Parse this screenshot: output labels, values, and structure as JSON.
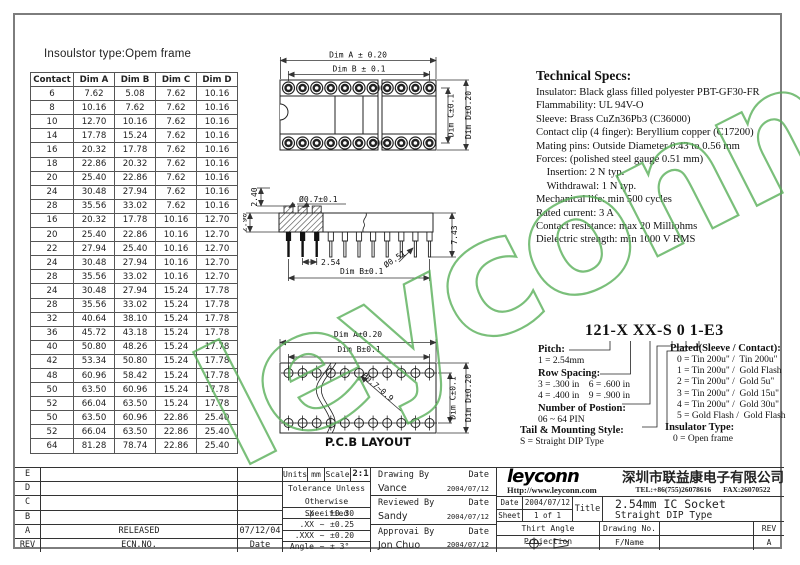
{
  "watermark": "leyconn",
  "insulator_note": "Insoulstor type:Opem frame",
  "dim_table": {
    "headers": [
      "Contact",
      "Dim A",
      "Dim B",
      "Dim C",
      "Dim D"
    ],
    "rows": [
      [
        "6",
        "7.62",
        "5.08",
        "7.62",
        "10.16"
      ],
      [
        "8",
        "10.16",
        "7.62",
        "7.62",
        "10.16"
      ],
      [
        "10",
        "12.70",
        "10.16",
        "7.62",
        "10.16"
      ],
      [
        "14",
        "17.78",
        "15.24",
        "7.62",
        "10.16"
      ],
      [
        "16",
        "20.32",
        "17.78",
        "7.62",
        "10.16"
      ],
      [
        "18",
        "22.86",
        "20.32",
        "7.62",
        "10.16"
      ],
      [
        "20",
        "25.40",
        "22.86",
        "7.62",
        "10.16"
      ],
      [
        "24",
        "30.48",
        "27.94",
        "7.62",
        "10.16"
      ],
      [
        "28",
        "35.56",
        "33.02",
        "7.62",
        "10.16"
      ],
      [
        "16",
        "20.32",
        "17.78",
        "10.16",
        "12.70"
      ],
      [
        "20",
        "25.40",
        "22.86",
        "10.16",
        "12.70"
      ],
      [
        "22",
        "27.94",
        "25.40",
        "10.16",
        "12.70"
      ],
      [
        "24",
        "30.48",
        "27.94",
        "10.16",
        "12.70"
      ],
      [
        "28",
        "35.56",
        "33.02",
        "10.16",
        "12.70"
      ],
      [
        "24",
        "30.48",
        "27.94",
        "15.24",
        "17.78"
      ],
      [
        "28",
        "35.56",
        "33.02",
        "15.24",
        "17.78"
      ],
      [
        "32",
        "40.64",
        "38.10",
        "15.24",
        "17.78"
      ],
      [
        "36",
        "45.72",
        "43.18",
        "15.24",
        "17.78"
      ],
      [
        "40",
        "50.80",
        "48.26",
        "15.24",
        "17.78"
      ],
      [
        "42",
        "53.34",
        "50.80",
        "15.24",
        "17.78"
      ],
      [
        "48",
        "60.96",
        "58.42",
        "15.24",
        "17.78"
      ],
      [
        "50",
        "63.50",
        "60.96",
        "15.24",
        "17.78"
      ],
      [
        "52",
        "66.04",
        "63.50",
        "15.24",
        "17.78"
      ],
      [
        "50",
        "63.50",
        "60.96",
        "22.86",
        "25.40"
      ],
      [
        "52",
        "66.04",
        "63.50",
        "22.86",
        "25.40"
      ],
      [
        "64",
        "81.28",
        "78.74",
        "22.86",
        "25.40"
      ]
    ]
  },
  "tech_specs": {
    "title": "Technical Specs:",
    "lines": [
      "Insulator: Black glass filled polyester PBT-GF30-FR",
      "Flammability: UL 94V-O",
      "Sleeve: Brass CuZn36Pb3 (C36000)",
      "Contact clip (4 finger): Beryllium copper (C17200)",
      "Mating pins: Outside Diameter 0.43 to 0.56 mm",
      "Forces: (polished steel gauge 0.51 mm)",
      "    Insertion: 2 N typ.",
      "    Withdrawal: 1 N typ.",
      "Mechanical life: min 500 cycles",
      "Rated current: 3 A",
      "Contact resistance: max 20 Milliohms",
      "Dielectric strength: min 1000 V RMS"
    ]
  },
  "drawings": {
    "top_view": {
      "dim_a": "Dim A ± 0.20",
      "dim_b": "Dim B ± 0.1",
      "dim_c": "Dim C±0.1",
      "dim_d": "Dim D±0.20"
    },
    "side_view": {
      "upper": "2.40",
      "standoff": "2.90",
      "sleeve_dia": "Ø0.7±0.1",
      "pitch": "2.54",
      "pin_dia": "Ø0.51",
      "dim_b": "Dim B±0.1",
      "height": "7.43"
    },
    "pcb_layout": {
      "dim_a": "Dim A±0.20",
      "dim_b": "Dim B±0.1",
      "hole_dia": "Ø0.7~0.9",
      "dim_c": "Dim C±0.1",
      "dim_d": "Dim D±0.20",
      "caption": "P.C.B LAYOUT"
    }
  },
  "part_number": {
    "code": "121-X XX-S 0 1-E3",
    "pitch_label": "Pitch:",
    "pitch_options": [
      "1 = 2.54mm"
    ],
    "row_spacing_label": "Row Spacing:",
    "row_spacing_options": [
      "3 = .300 in    6 = .600 in",
      "4 = .400 in    9 = .900 in"
    ],
    "positions_label": "Number of Postion:",
    "positions_options": [
      "06 ~ 64 PIN"
    ],
    "tail_label": "Tail & Mounting Style:",
    "tail_options": [
      "S = Straight DIP Type"
    ],
    "plated_label": "Plated(Sleeve / Contact):",
    "plated_options": [
      "0 = Tin 200u\" /  Tin 200u\"",
      "1 = Tin 200u\" /  Gold Flash",
      "2 = Tin 200u\" /  Gold 5u\"",
      "3 = Tin 200u\" /  Gold 15u\"",
      "4 = Tin 200u\" /  Gold 30u\"",
      "5 = Gold Flash /  Gold Flash"
    ],
    "insulator_label": "Insulator Type:",
    "insulator_options": [
      "0 = Open frame"
    ]
  },
  "title_block": {
    "revision_rows": [
      [
        "E",
        "",
        ""
      ],
      [
        "D",
        "",
        ""
      ],
      [
        "C",
        "",
        ""
      ],
      [
        "B",
        "",
        ""
      ],
      [
        "A",
        "RELEASED",
        "07/12/04"
      ],
      [
        "REV",
        "ECN.NO.",
        "Date"
      ]
    ],
    "units_label": "Units",
    "units_value": "mm",
    "scale_label": "Scale",
    "scale_value": "2:1",
    "tolerance_note": "Tolerance Unless Otherwise Specified",
    "tolerance_rows": [
      [
        ".X",
        "~",
        "±0.30"
      ],
      [
        ".XX",
        "~",
        "±0.25"
      ],
      [
        ".XXX",
        "~",
        "±0.20"
      ],
      [
        "Angle",
        "~",
        "± 3°"
      ]
    ],
    "signatures": [
      {
        "role": "Drawing By",
        "date_label": "Date",
        "name": "Vance",
        "date": "2004/07/12"
      },
      {
        "role": "Reviewed By",
        "date_label": "Date",
        "name": "Sandy",
        "date": "2004/07/12"
      },
      {
        "role": "Approvai By",
        "date_label": "Date",
        "name": "Jon Chuo",
        "date": "2004/07/12"
      }
    ],
    "logo": "leyconn",
    "website": "Http://www.leyconn.com",
    "company_cn": "深圳市联益康电子有限公司",
    "tel": "TEL:+86(755)26078616",
    "fax": "FAX:26070522",
    "date_label": "Date",
    "date_value": "2004/07/12",
    "sheet_label": "Sheet",
    "sheet_value": "1 of 1",
    "title_label": "Title",
    "title_line1": "2.54mm IC Socket",
    "title_line2": "Straight DIP Type",
    "projection_label": "Thirt Angle Projection",
    "drawing_no_label": "Drawing No.",
    "rev_label": "REV",
    "fname_label": "F/Name",
    "rev_value": "A"
  }
}
